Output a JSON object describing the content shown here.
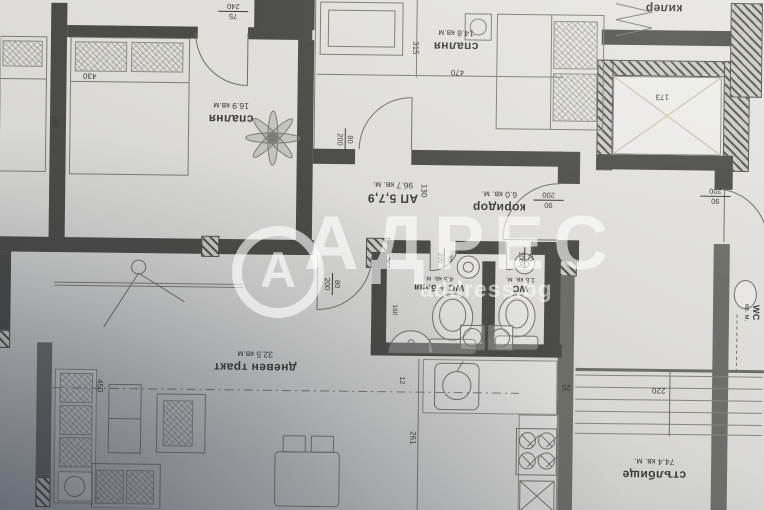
{
  "title": "floor-plan-photo",
  "watermark": {
    "brand": "АДРЕС",
    "logo_letter": "А",
    "sub": "address.bg"
  },
  "rooms": [
    {
      "name": "спалня",
      "area": "16.9 кв.м"
    },
    {
      "name": "спалня",
      "area": "14.8 кв.м"
    },
    {
      "name": "килер",
      "area": "2.8 кв.м"
    },
    {
      "name": "АП 5,7,9",
      "area": "96.7 кв. м."
    },
    {
      "name": "коридор",
      "area": "6.0 кв. м."
    },
    {
      "name": "WC + баня",
      "area": "4.3 кв. м."
    },
    {
      "name": "WC",
      "area": "1.8 кв. м."
    },
    {
      "name": "дневен тракт",
      "area": "32.5 кв.м"
    },
    {
      "name": "стълбище",
      "area": "74.4 кв. м."
    },
    {
      "name": "WC",
      "area": "кв. м."
    }
  ],
  "doors": [
    {
      "num": "75",
      "den": "240"
    },
    {
      "num": "80",
      "den": "200"
    },
    {
      "num": "80",
      "den": "200"
    },
    {
      "num": "90",
      "den": "200"
    },
    {
      "num": "70",
      "den": "200"
    },
    {
      "num": "70",
      "den": "200"
    },
    {
      "num": "90",
      "den": "200"
    }
  ],
  "dims": [
    "430",
    "395",
    "315",
    "470",
    "173",
    "130",
    "160",
    "12",
    "261",
    "450",
    "25",
    "220"
  ],
  "colors": {
    "paper": "#dcdbd8",
    "wall": "#4b4b48",
    "line": "#7b7b75",
    "watermark": "#ffffff"
  }
}
